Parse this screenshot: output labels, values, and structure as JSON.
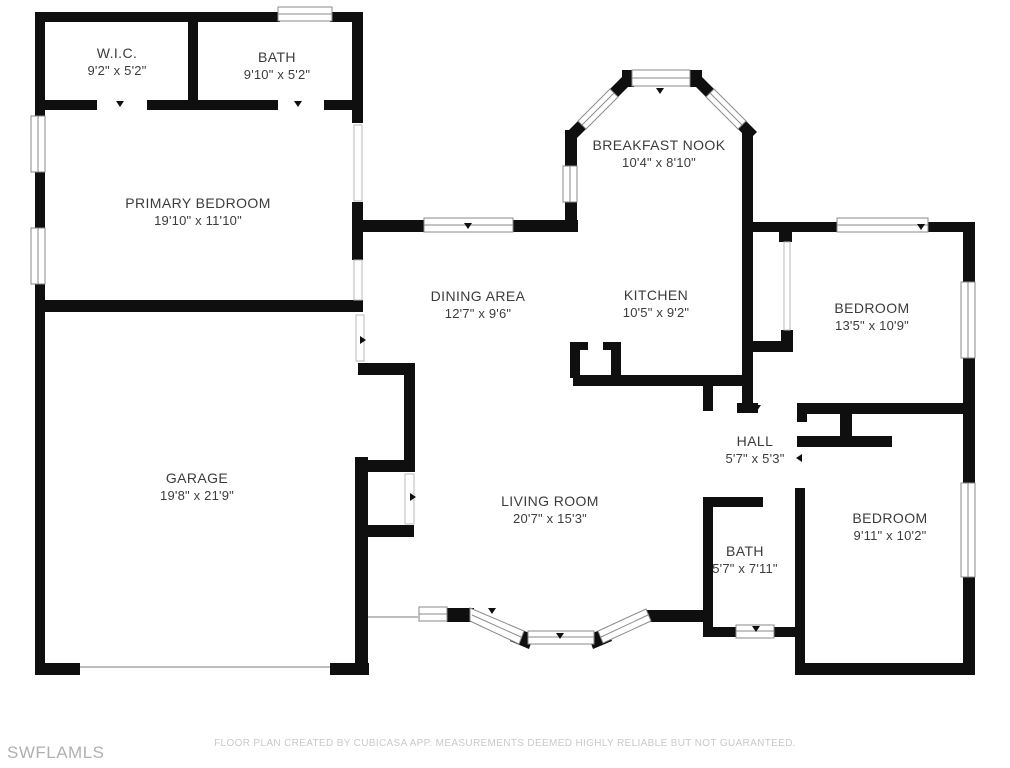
{
  "floor_plan": {
    "rooms": [
      {
        "id": "wic",
        "name": "W.I.C.",
        "dims": "9'2\" x 5'2\""
      },
      {
        "id": "bath_top",
        "name": "BATH",
        "dims": "9'10\" x 5'2\""
      },
      {
        "id": "primary_bedroom",
        "name": "PRIMARY BEDROOM",
        "dims": "19'10\" x 11'10\""
      },
      {
        "id": "breakfast_nook",
        "name": "BREAKFAST NOOK",
        "dims": "10'4\" x 8'10\""
      },
      {
        "id": "dining_area",
        "name": "DINING AREA",
        "dims": "12'7\" x 9'6\""
      },
      {
        "id": "kitchen",
        "name": "KITCHEN",
        "dims": "10'5\" x 9'2\""
      },
      {
        "id": "bedroom_ne",
        "name": "BEDROOM",
        "dims": "13'5\" x 10'9\""
      },
      {
        "id": "hall",
        "name": "HALL",
        "dims": "5'7\" x 5'3\""
      },
      {
        "id": "garage",
        "name": "GARAGE",
        "dims": "19'8\" x 21'9\""
      },
      {
        "id": "living_room",
        "name": "LIVING ROOM",
        "dims": "20'7\" x 15'3\""
      },
      {
        "id": "bath_right",
        "name": "BATH",
        "dims": "5'7\" x 7'11\""
      },
      {
        "id": "bedroom_se",
        "name": "BEDROOM",
        "dims": "9'11\" x 10'2\""
      }
    ],
    "footer": {
      "disclaimer": "FLOOR PLAN CREATED BY CUBICASA APP. MEASUREMENTS DEEMED HIGHLY RELIABLE BUT NOT GUARANTEED.",
      "watermark": "SWFLAMLS"
    }
  },
  "colors": {
    "wall": "#0f0f0f",
    "window_line": "#8a8a8a",
    "label": "#3c3c3c",
    "footer": "#c9c9c9",
    "watermark": "#b0b0b0",
    "bg": "#ffffff"
  }
}
